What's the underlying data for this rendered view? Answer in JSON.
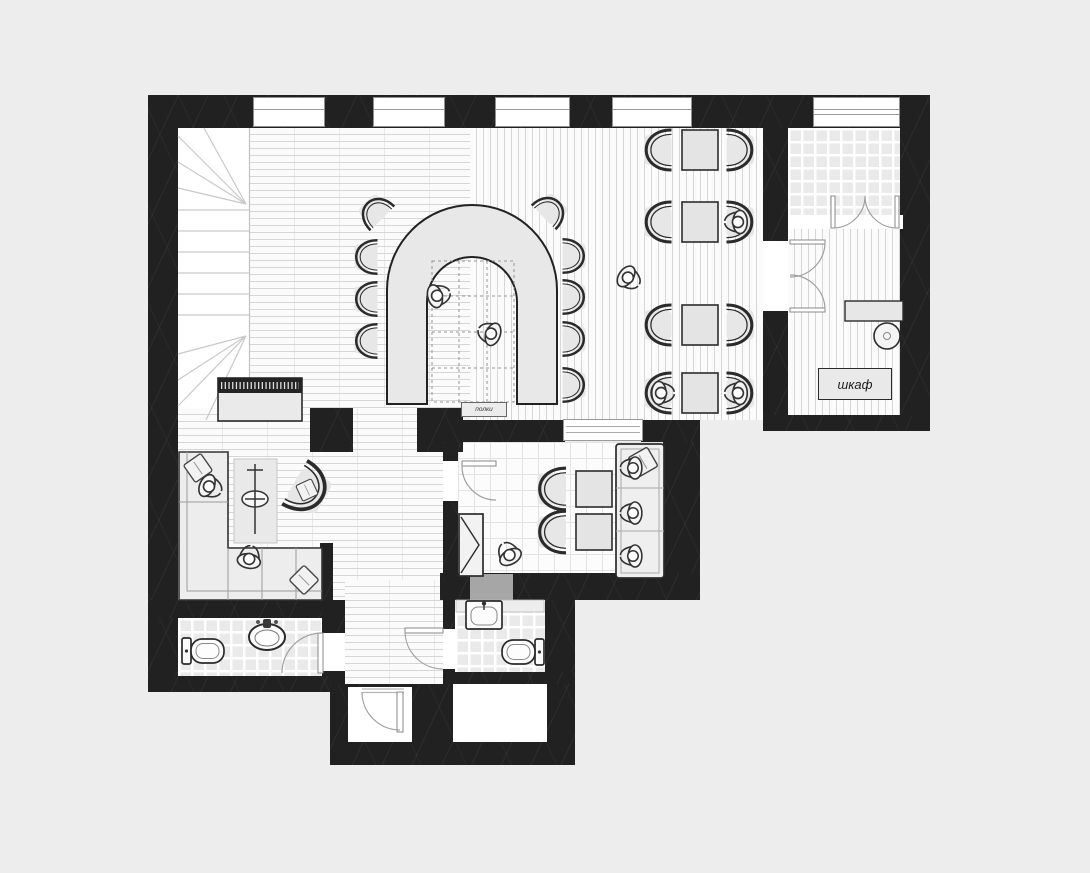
{
  "labels": {
    "wardrobe": "шкаф",
    "shelves": "полки"
  },
  "palette": {
    "background": "#ededed",
    "wall": "#212121",
    "floor": "#fbfbfb",
    "floor_line": "#d6d6d6",
    "tile_base": "#eaeaea",
    "furniture_fill": "#e7e7e7",
    "outline": "#2b2b2b",
    "door_arc": "#a0a0a0",
    "mat": "#a6a6a6"
  },
  "plan": {
    "rooms": [
      {
        "name": "staircase",
        "floor": "plain"
      },
      {
        "name": "bar-area",
        "floor": "plank-horizontal"
      },
      {
        "name": "dining-area",
        "floor": "plank-vertical"
      },
      {
        "name": "terrace-vestibule",
        "floor": "mosaic-tile"
      },
      {
        "name": "wardrobe-room",
        "floor": "plank-vertical"
      },
      {
        "name": "lounge",
        "floor": "plank-horizontal"
      },
      {
        "name": "private-room",
        "floor": "square-tile"
      },
      {
        "name": "wc-left",
        "floor": "mosaic-tile"
      },
      {
        "name": "wc-right",
        "floor": "mosaic-tile"
      },
      {
        "name": "corridor",
        "floor": "plank-horizontal"
      },
      {
        "name": "entry-porch",
        "floor": "plain"
      }
    ],
    "furniture_counts": {
      "bar_stools": 9,
      "dining_tables": 4,
      "dining_chairs": 8,
      "people": 12,
      "windows": 5
    }
  }
}
